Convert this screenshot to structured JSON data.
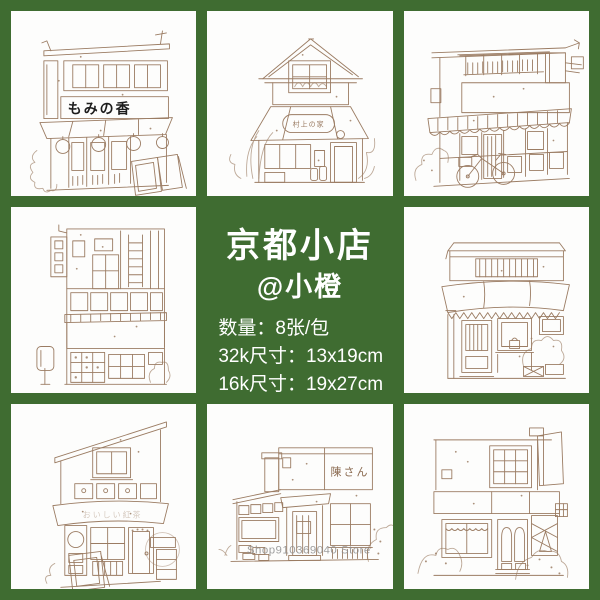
{
  "colors": {
    "background_green": "#3f6c31",
    "paper_white": "#fdfdfc",
    "line_sepia": "#9b7c63",
    "sign_black": "#1c1c1c",
    "watermark_gray": "#8f8f8f",
    "text_white": "#ffffff"
  },
  "center_panel": {
    "title": "京都小店",
    "subtitle": "@小橙",
    "specs": [
      "数量：8张/包",
      "32k尺寸：13x19cm",
      "16k尺寸：19x27cm"
    ]
  },
  "drawings": {
    "top_left": {
      "sign_text": "もみの香"
    },
    "top_middle": {
      "sign_text": "村上の家"
    },
    "bottom_left": {
      "awning_text": "おいしい紅茶"
    },
    "bottom_middle": {
      "sign_text": "陳さん"
    }
  },
  "watermark": {
    "store_text": "Shop910369040 Store"
  }
}
